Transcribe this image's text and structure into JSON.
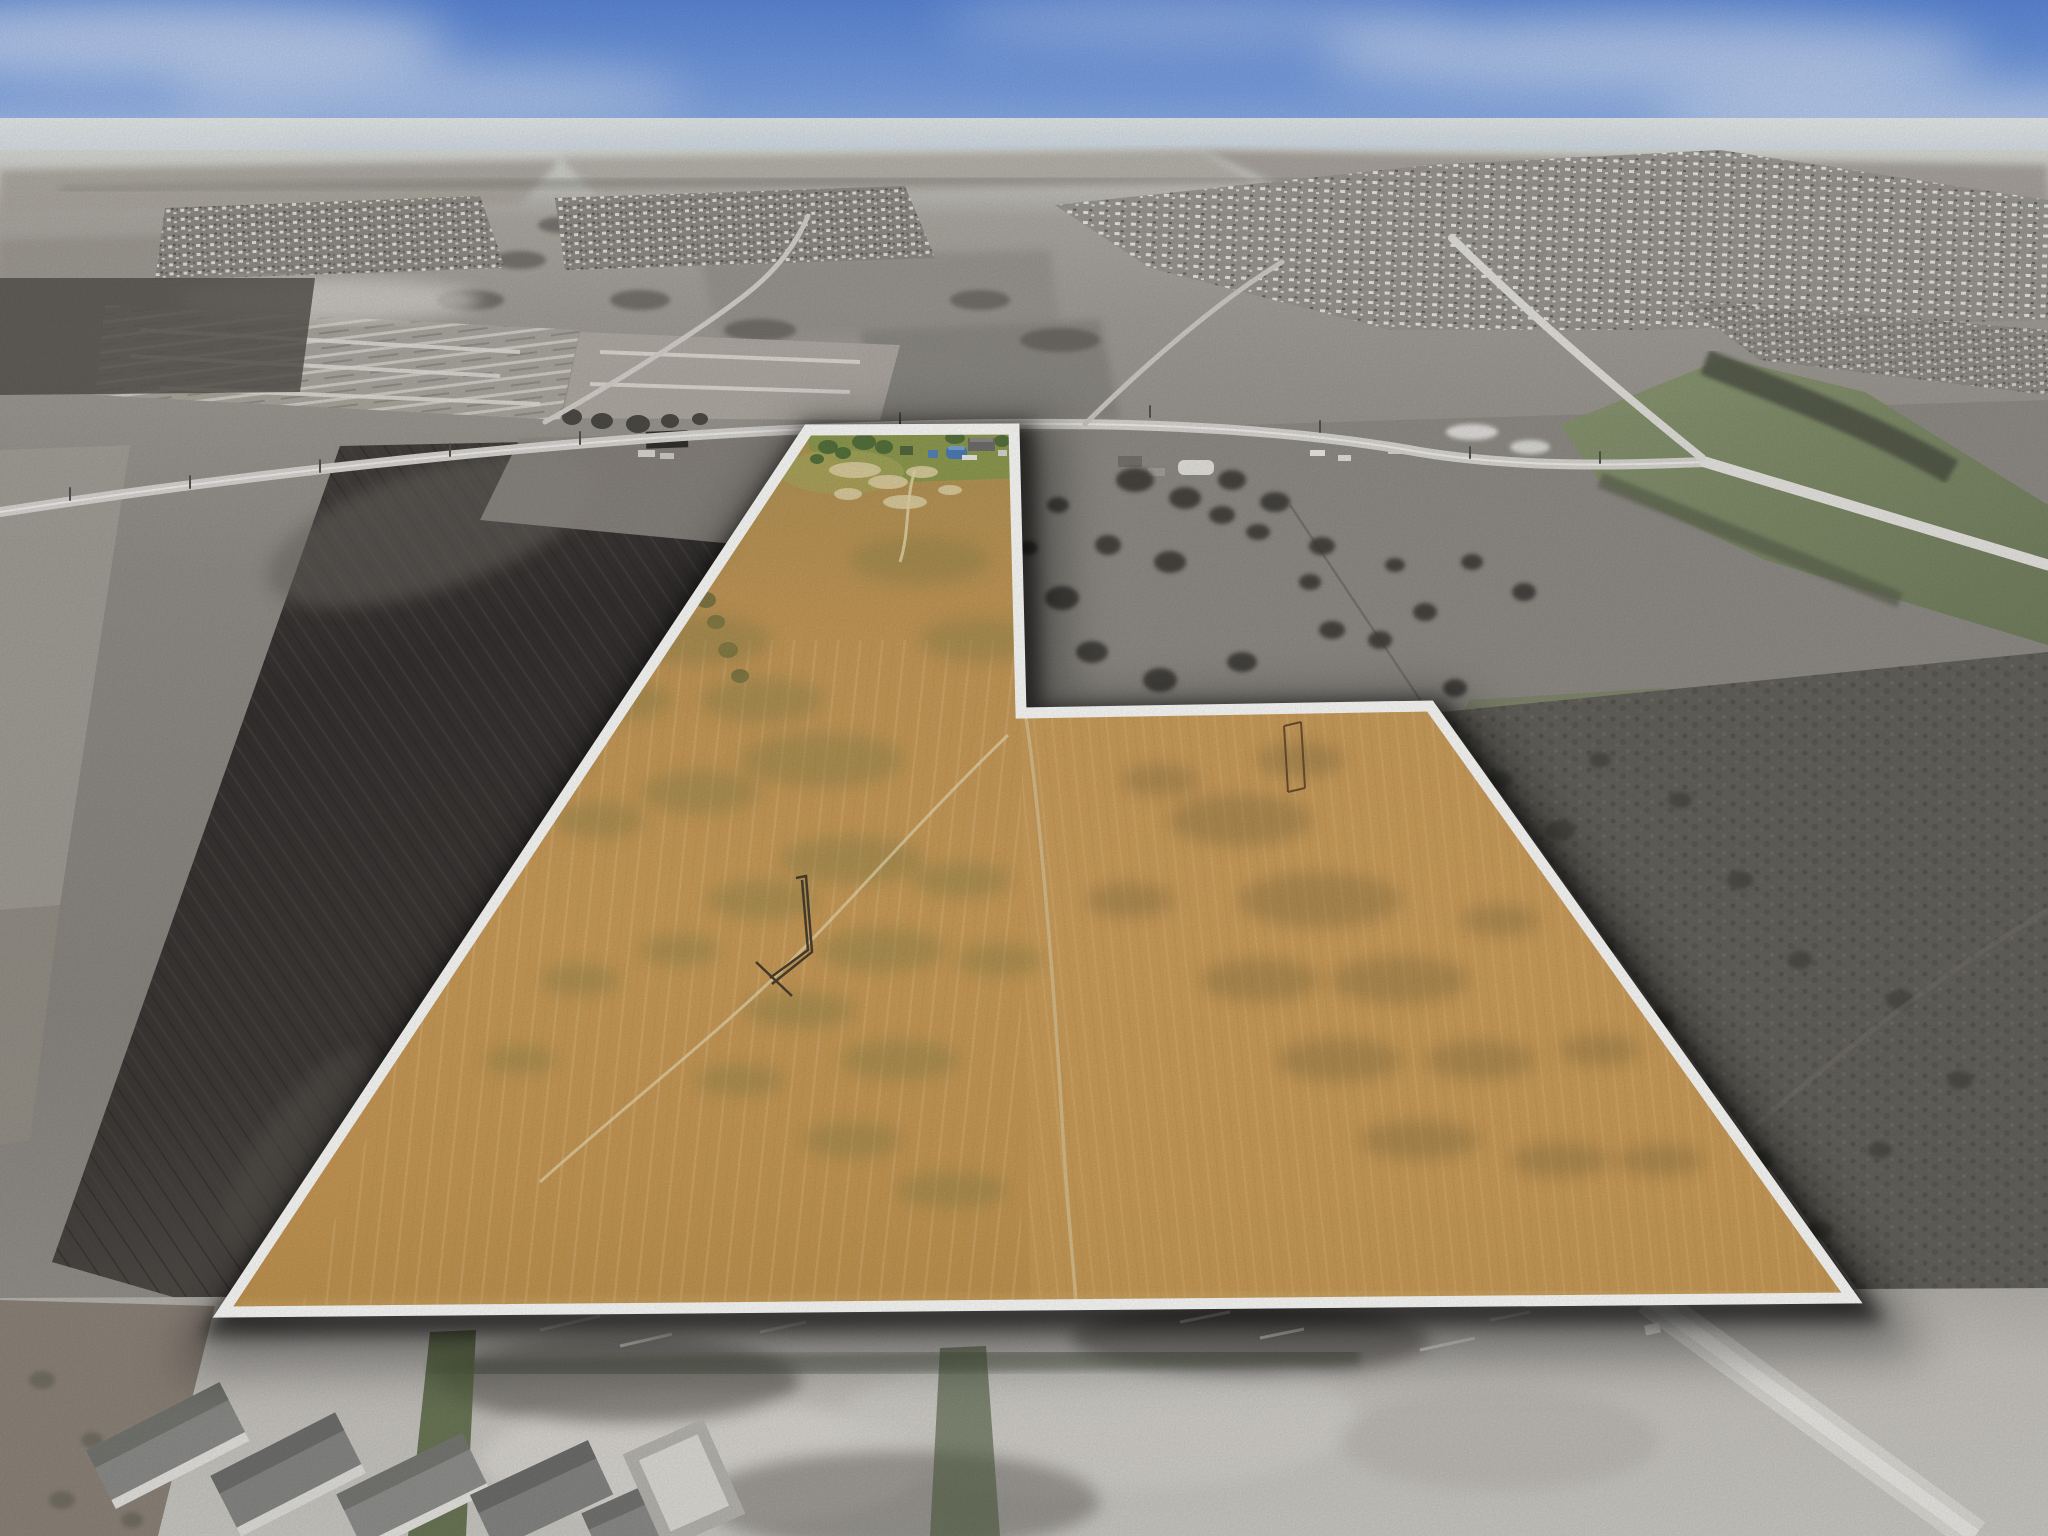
{
  "scene": {
    "description": "Aerial drone photograph of a large rural land parcel outlined in white. The parcel interior is shown in golden amber color while the surrounding landscape is desaturated gray. A small farmstead with blue-roofed barns sits at the top of the parcel along an east-west road. Dark plowed field to the left, gray pasture with scattered trees to the right, distant housing subdivisions and hazy blue sky at the horizon, and new home construction along the bottom edge.",
    "type": "aerial-real-estate-photo"
  },
  "palette": {
    "sky_top": "#5b87d7",
    "sky_mid": "#a9c2ec",
    "horizon_haze": "#e4e8e4",
    "ground_gray": "#8e8b85",
    "plowed_field": "#3b3835",
    "construction_light": "#c6c3be",
    "parcel_amber": "#c89a58",
    "parcel_olive": "#8f8448",
    "parcel_green_top": "#8d9a4f",
    "boundary_white": "#fbfbf9",
    "shadow": "#000000",
    "tree_gray": "#3c3b37",
    "barn_blue": "#4d7cb7",
    "valley_green": "#7a8a5e"
  },
  "parcel": {
    "outline_points": "808,430 1014,429 1021,713 1430,706 1852,1298 223,1312",
    "features": [
      "blue-roof-quonset-barn",
      "farm-house",
      "sandy-patches",
      "winding-field-track",
      "corral-fence",
      "goalpost-structure",
      "interior-division-track"
    ]
  }
}
